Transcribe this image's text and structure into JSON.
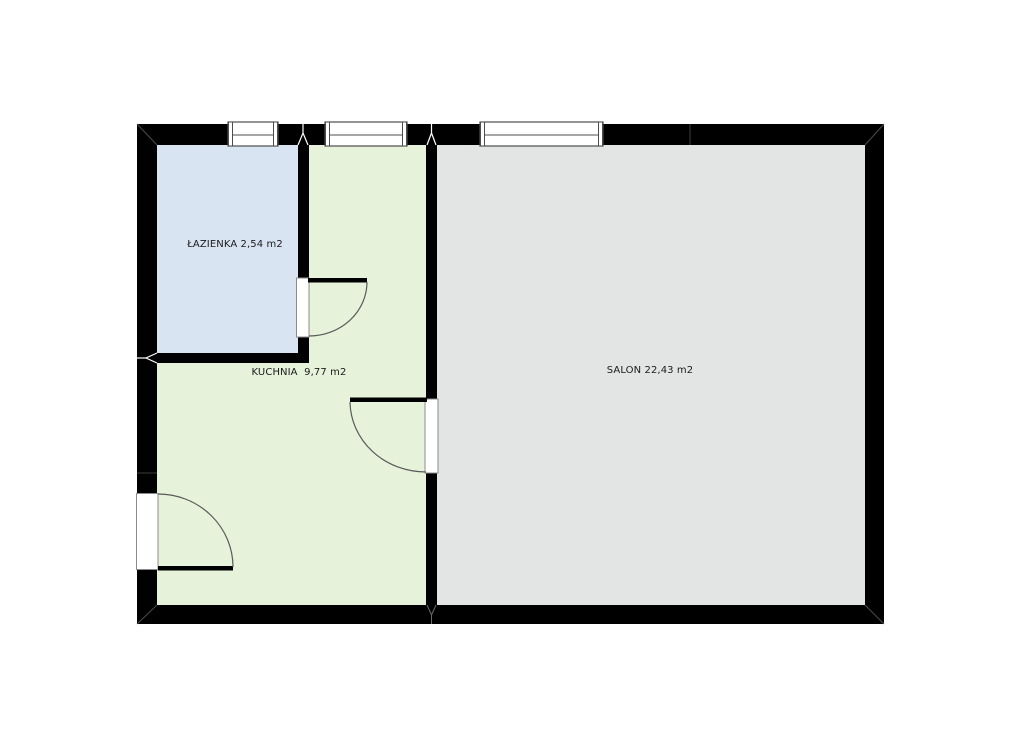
{
  "page": {
    "background": "#ffffff"
  },
  "plan": {
    "type": "apartment-floor-plan",
    "wall_color": "#000000",
    "opening_fill": "#ffffff",
    "label_color": "#1b1b1b",
    "swing_stroke": "#5a5a5a",
    "frame_stroke": "#4d4d4d",
    "rooms": [
      {
        "name": "ŁAZIENKA",
        "area": "2,54 m2",
        "label": "ŁAZIENKA 2,54 m2",
        "fill": "#d9e4f3"
      },
      {
        "name": "KUCHNIA",
        "area": "9,77 m2",
        "label": "KUCHNIA  9,77 m2",
        "fill": "#e6f2da"
      },
      {
        "name": "SALON",
        "area": "22,43 m2",
        "label": "SALON 22,43 m2",
        "fill": "#e2e5e4"
      }
    ]
  }
}
